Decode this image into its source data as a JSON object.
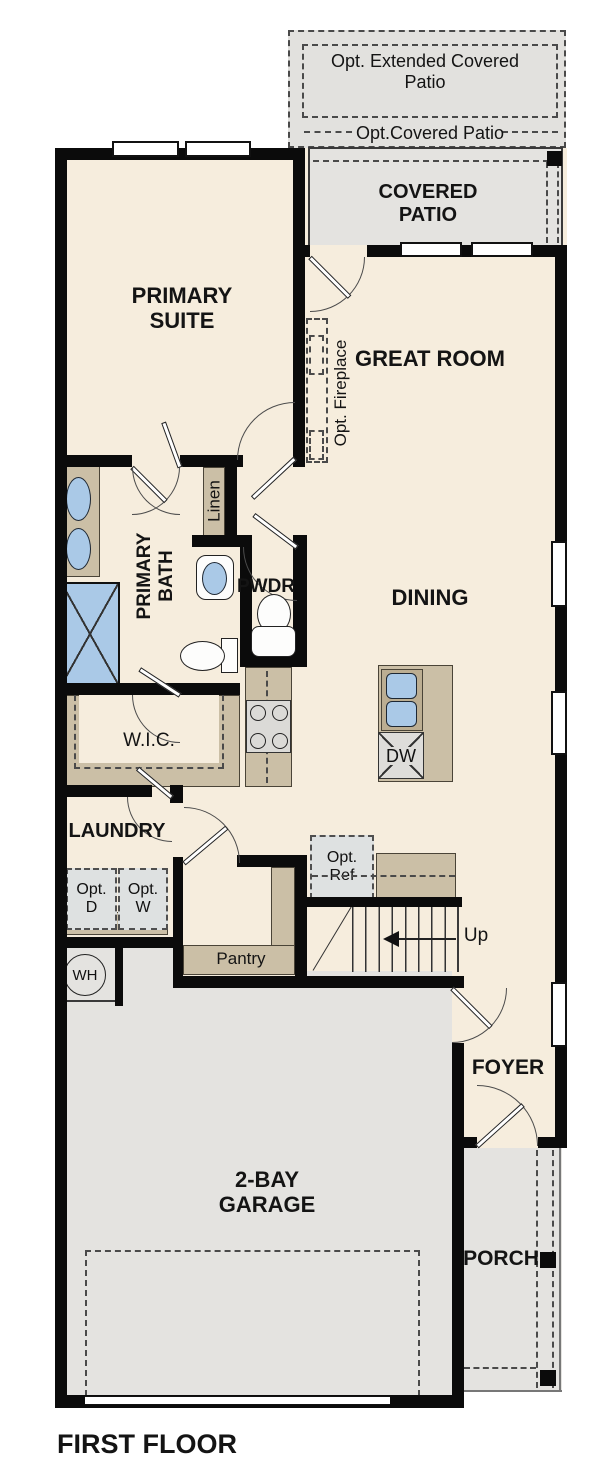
{
  "title": "FIRST FLOOR",
  "colors": {
    "floor_cream": "#f6eddd",
    "patio_garage_gray": "#e4e3e0",
    "cabinet_tan": "#cbbfa6",
    "fixture_blue": "#aac9e7",
    "appliance_gray": "#dbdad7",
    "option_box_gray": "#dee1e1",
    "wall_black": "#0b0b0b"
  },
  "rooms": {
    "opt_extended_patio": "Opt. Extended Covered Patio",
    "opt_covered_patio": "Opt.Covered Patio",
    "covered_patio": "COVERED PATIO",
    "primary_suite": "PRIMARY SUITE",
    "great_room": "GREAT ROOM",
    "dining": "DINING",
    "primary_bath": "PRIMARY BATH",
    "pwdr": "PWDR",
    "wic": "W.I.C.",
    "laundry": "LAUNDRY",
    "pantry": "Pantry",
    "foyer": "FOYER",
    "garage": "2-BAY GARAGE",
    "porch": "PORCH"
  },
  "features": {
    "opt_fireplace": "Opt. Fireplace",
    "linen": "Linen",
    "dishwasher": "DW",
    "opt_dryer": "Opt. D",
    "opt_washer": "Opt. W",
    "opt_refrigerator": "Opt. Ref",
    "water_heater": "WH",
    "stairs_direction": "Up"
  }
}
